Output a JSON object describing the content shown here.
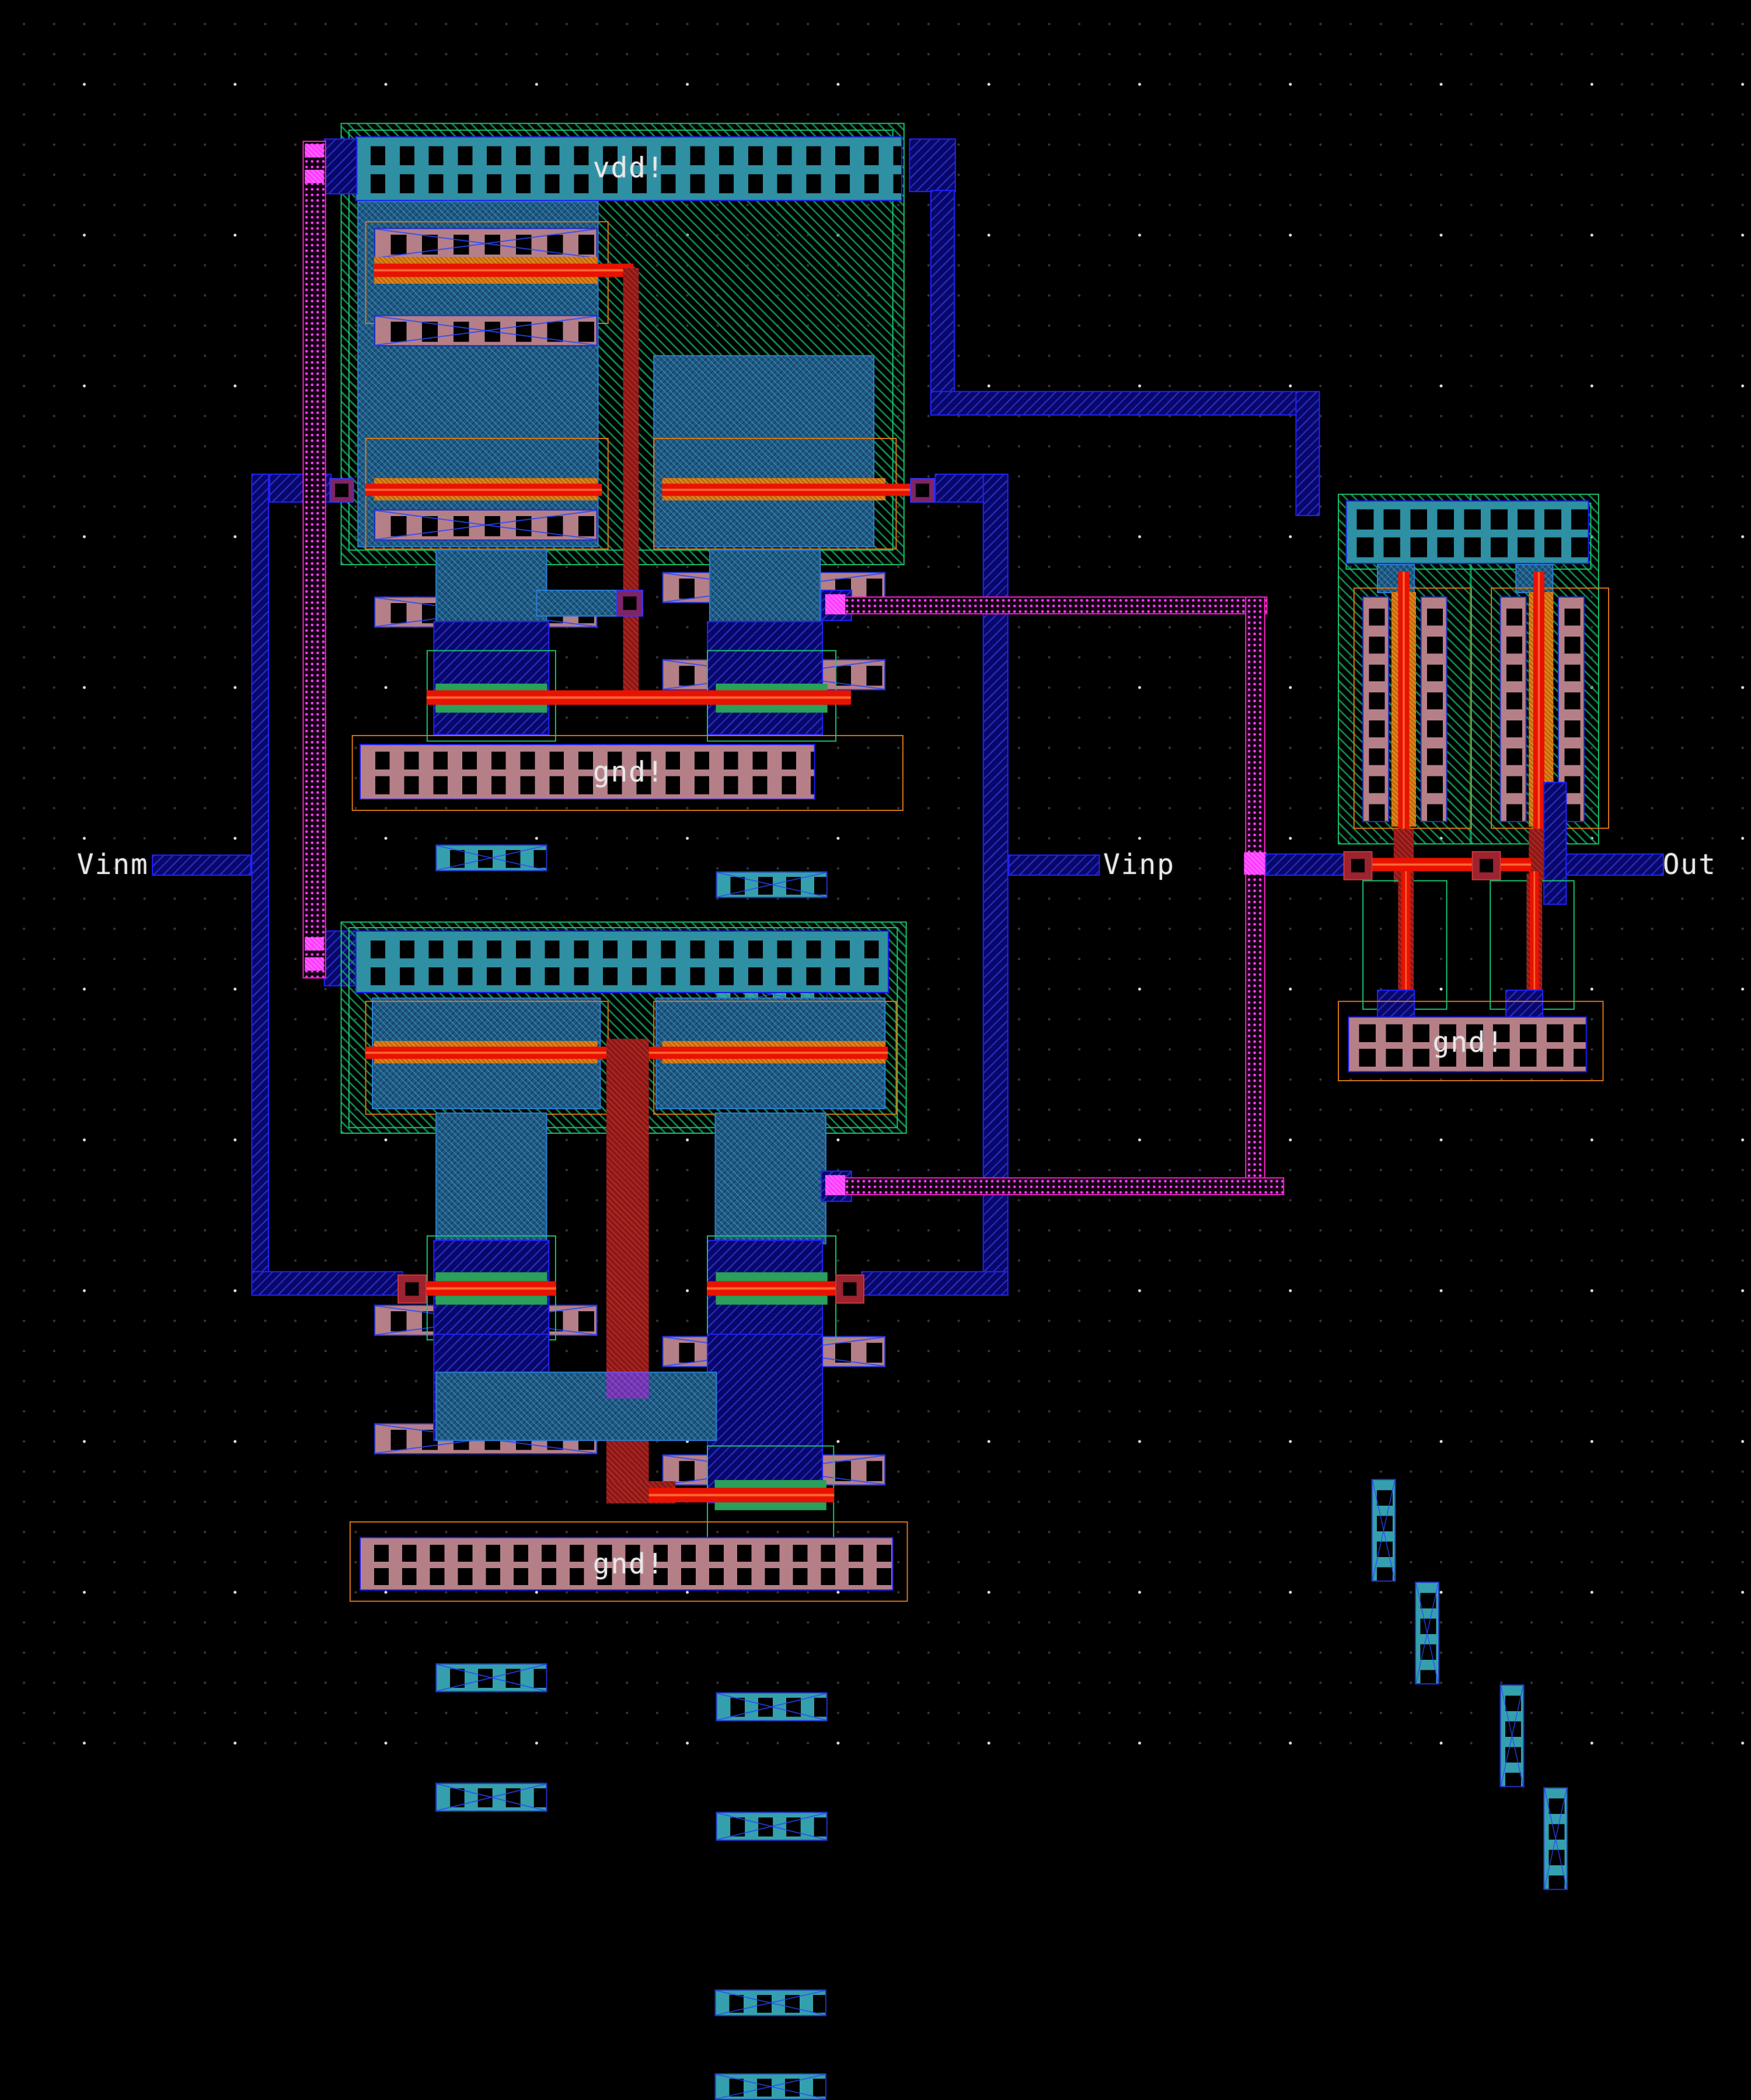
{
  "colors": {
    "background": "#000000",
    "outline_green": "#17c973",
    "outline_orange": "#e07812",
    "nwell_hatch_green": "#10a558",
    "rail_metal_teal": "#2f8fa3",
    "rail_border_blue": "#1b1bff",
    "contact_pink": "#b57f88",
    "contact_teal": "#35a0ad",
    "diffusion_green": "#2aa05a",
    "poly_red": "#e81200",
    "poly_orange": "#c46a10",
    "poly_route_crimson": "#8c1818",
    "metal1_steel": "#1d5a86",
    "metal2_navy": "#08086b",
    "metal2_border": "#2222ff",
    "metal3_magenta": "#ff22cc",
    "via_magenta": "#ff3bff",
    "contact_box_red": "#9c2330",
    "contact_box_purple": "#7e2468",
    "label_text": "#e8e8e8"
  },
  "labels": {
    "vdd_rail": "vdd!",
    "gnd_rail": "gnd!",
    "port_vinm": "Vinm",
    "port_vinp": "Vinp",
    "port_out": "Out"
  }
}
